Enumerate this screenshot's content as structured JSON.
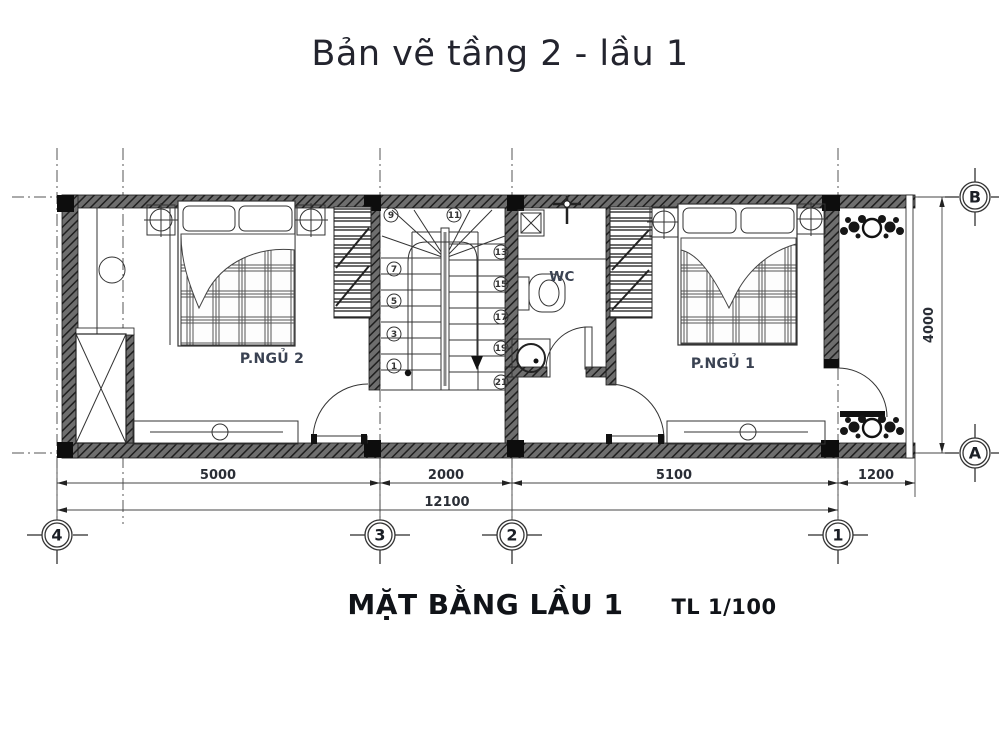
{
  "title": "Bản vẽ tầng 2 - lầu 1",
  "caption": {
    "name": "MẶT BẰNG LẦU 1",
    "scale": "TL 1/100"
  },
  "rooms": {
    "bedroom2": {
      "label": "P.NGỦ 2"
    },
    "bedroom1": {
      "label": "P.NGỦ 1"
    },
    "wc": {
      "label": "WC"
    }
  },
  "grid": {
    "columns": [
      {
        "label": "4"
      },
      {
        "label": "3"
      },
      {
        "label": "2"
      },
      {
        "label": "1"
      }
    ],
    "rows": [
      {
        "label": "B"
      },
      {
        "label": "A"
      }
    ]
  },
  "dimensions": {
    "segments": [
      {
        "value": "5000"
      },
      {
        "value": "2000"
      },
      {
        "value": "5100"
      },
      {
        "value": "1200"
      }
    ],
    "total": {
      "value": "12100"
    },
    "depth": {
      "value": "4000"
    }
  },
  "stairs": {
    "left": [
      "9",
      "7",
      "5",
      "3",
      "1"
    ],
    "right": [
      "11",
      "13",
      "15",
      "17",
      "19",
      "21"
    ]
  },
  "colors": {
    "ink": "#1a1a1a",
    "label": "#3a4252",
    "title": "#23242e",
    "wall": "#555555"
  }
}
